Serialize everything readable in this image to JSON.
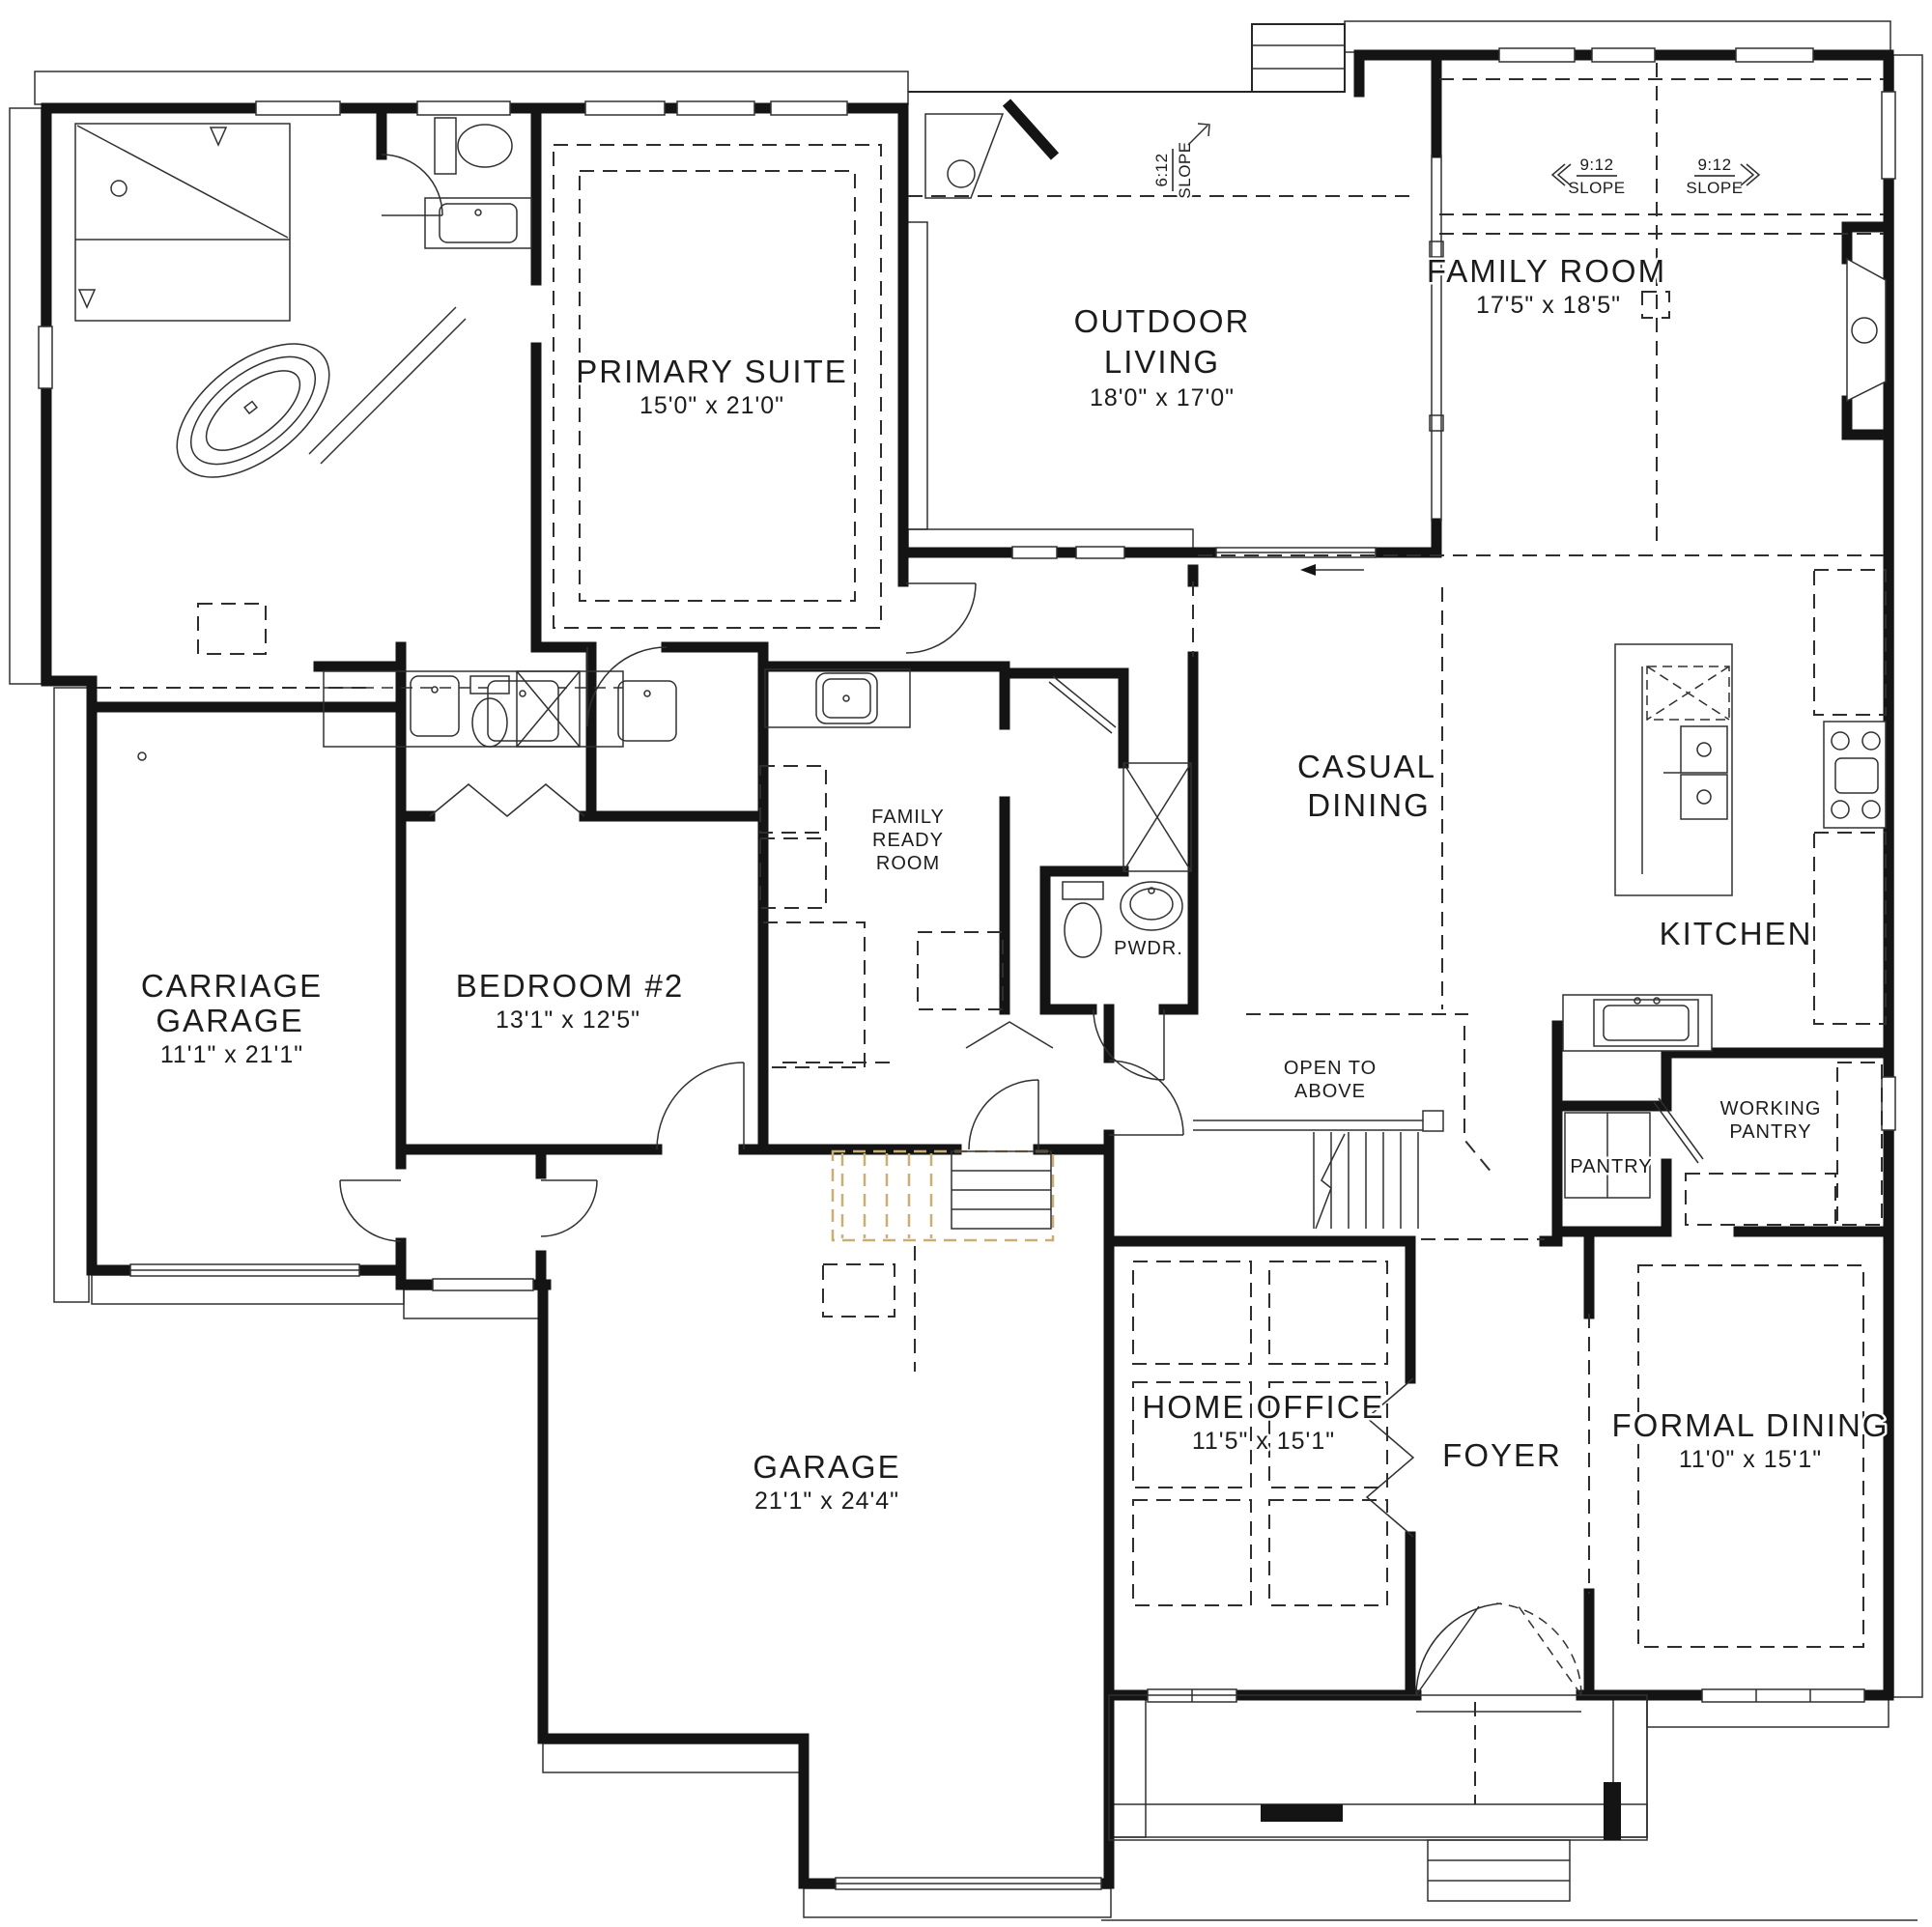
{
  "colors": {
    "wall": "#141414",
    "line": "#262626",
    "stair_highlight": "#c9af76",
    "background": "#ffffff",
    "text": "#1c1c1c"
  },
  "rooms": {
    "primary": {
      "name": "PRIMARY SUITE",
      "dims": "15'0\" x 21'0\""
    },
    "outdoor": {
      "l1": "OUTDOOR",
      "l2": "LIVING",
      "dims": "18'0\" x 17'0\""
    },
    "family": {
      "name": "FAMILY ROOM",
      "dims": "17'5\" x 18'5\""
    },
    "casual": {
      "l1": "CASUAL",
      "l2": "DINING"
    },
    "kitchen": {
      "name": "KITCHEN"
    },
    "carriage": {
      "l1": "CARRIAGE",
      "l2": "GARAGE",
      "dims": "11'1\" x 21'1\""
    },
    "bedroom2": {
      "name": "BEDROOM #2",
      "dims": "13'1\" x 12'5\""
    },
    "ready": {
      "l1": "FAMILY",
      "l2": "READY",
      "l3": "ROOM"
    },
    "pwdr": {
      "name": "PWDR."
    },
    "open": {
      "l1": "OPEN TO",
      "l2": "ABOVE"
    },
    "pantry": {
      "name": "PANTRY"
    },
    "working": {
      "l1": "WORKING",
      "l2": "PANTRY"
    },
    "office": {
      "name": "HOME OFFICE",
      "dims": "11'5\" x 15'1\""
    },
    "foyer": {
      "name": "FOYER"
    },
    "formal": {
      "name": "FORMAL DINING",
      "dims": "11'0\" x 15'1\""
    },
    "garage": {
      "name": "GARAGE",
      "dims": "21'1\" x 24'4\""
    }
  },
  "slopes": {
    "s6": {
      "ratio": "6:12",
      "word": "SLOPE"
    },
    "s9l": {
      "ratio": "9:12",
      "word": "SLOPE"
    },
    "s9r": {
      "ratio": "9:12",
      "word": "SLOPE"
    }
  }
}
